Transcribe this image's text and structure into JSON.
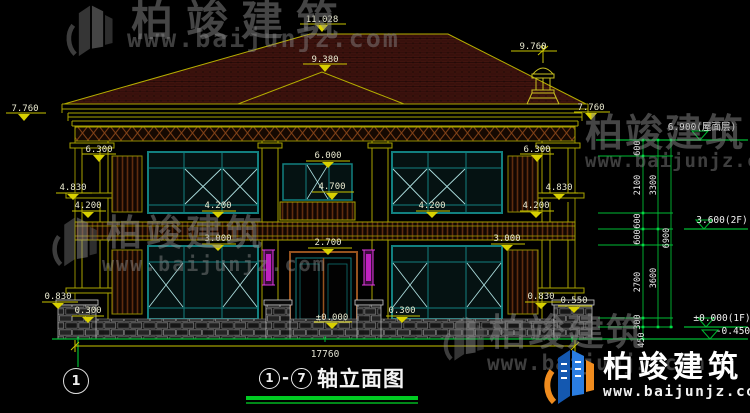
{
  "title_block": {
    "axis_start": "1",
    "separator": "-",
    "axis_end": "7",
    "label": "轴立面图"
  },
  "axis_bubble": {
    "label": "1"
  },
  "watermarks": {
    "brand": "柏竣建筑",
    "url": "www.baijunjz.com"
  },
  "footer_logo": {
    "brand": "柏竣建筑",
    "url": "www.baijunjz.com"
  },
  "dimensions": {
    "overall_width": "17760",
    "apex": "11.028",
    "ridge": "9.380",
    "finial": "9.760",
    "eave_left": "7.760",
    "eave_right": "7.760",
    "frieze_left": "6.300",
    "frieze_right": "6.300",
    "head_2f_center": "6.000",
    "sill_2f_center": "4.700",
    "parapet_left": "4.830",
    "parapet_right": "4.830",
    "sill_2f_outer_left": "4.200",
    "sill_2f_inner_left": "4.200",
    "sill_2f_inner_right": "4.200",
    "sill_2f_outer_right": "4.200",
    "head_1f_left": "3.000",
    "head_1f_right": "3.000",
    "door_head": "2.700",
    "plinth_left": "0.830",
    "plinth_right": "0.830",
    "base_left": "0.300",
    "base_door": "0.300",
    "base_right": "0.550",
    "ground": "±0.000"
  },
  "right_chain": {
    "col1": [
      "600",
      "2100",
      "600",
      "600",
      "2700",
      "300"
    ],
    "below_datum": "450",
    "col2": [
      "3300",
      "3600"
    ],
    "col3": "6900",
    "levels": {
      "roof": "6.900(屋面层)",
      "floor2": "3.600(2F)",
      "floor1": "±0.000(1F)",
      "foundation": "-0.450"
    }
  },
  "colors": {
    "background": "#000000",
    "dim_line_yellow": "#c9c400",
    "dim_text": "#e9e9cf",
    "chain_green": "#00bb33",
    "window_teal": "#128080",
    "lamp_magenta": "#dd3ddd",
    "roof_tile": "#38100c",
    "title_underline": "#00cc22"
  }
}
